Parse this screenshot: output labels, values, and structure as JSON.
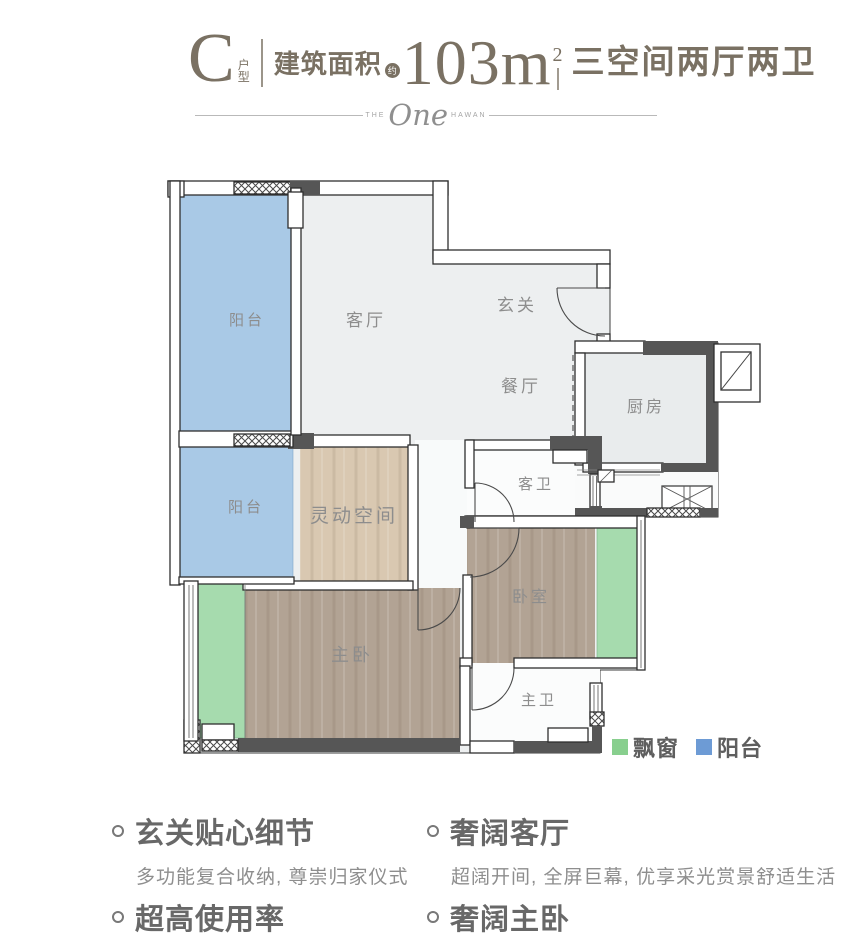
{
  "header": {
    "unit_letter": "C",
    "unit_type_top": "户",
    "unit_type_bottom": "型",
    "area_label": "建筑面积",
    "area_approx": "约",
    "area_value": "103m",
    "area_sup": "2",
    "layout_desc": "三空间两厅两卫"
  },
  "divider": {
    "pre": "THE",
    "brand": "One",
    "post": "HAWAN"
  },
  "plan": {
    "rooms": {
      "balcony_top": "阳台",
      "balcony_bottom": "阳台",
      "living": "客厅",
      "foyer": "玄关",
      "dining": "餐厅",
      "kitchen": "厨房",
      "guest_bath": "客卫",
      "flex": "灵动空间",
      "master": "主卧",
      "bedroom": "卧室",
      "master_bath": "主卫"
    },
    "colors": {
      "balcony": "#a9c9e6",
      "bay_window": "#a6dbae",
      "flex_floor": "#d9c8b1",
      "wood_floor": "#b2a394",
      "living_floor": "#edeff0",
      "wall_dark": "#565656",
      "legend_green": "#88cf8e",
      "legend_blue": "#6d9bd5"
    },
    "legend": [
      {
        "label": "飘窗",
        "color": "#88cf8e"
      },
      {
        "label": "阳台",
        "color": "#6d9bd5"
      }
    ]
  },
  "features": [
    {
      "title": "玄关贴心细节",
      "desc": "多功能复合收纳, 尊崇归家仪式"
    },
    {
      "title": "奢阔客厅",
      "desc": "超阔开间, 全屏巨幕, 优享采光赏景舒适生活"
    },
    {
      "title": "超高使用率",
      "desc": ""
    },
    {
      "title": "奢阔主卧",
      "desc": ""
    }
  ]
}
